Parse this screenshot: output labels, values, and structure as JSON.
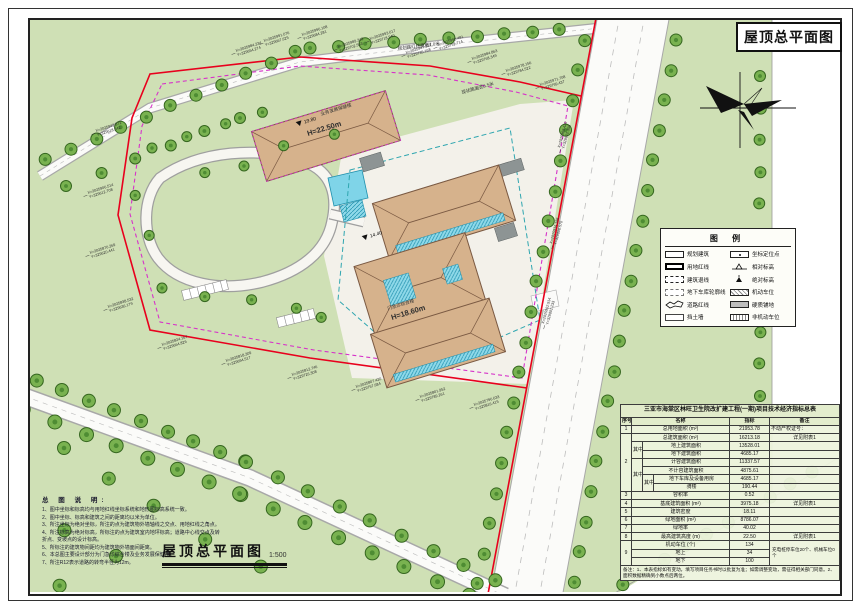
{
  "sheet": {
    "corner_title": "屋顶总平面图",
    "bottom_title": "屋顶总平面图",
    "bottom_scale": "1:500"
  },
  "legend": {
    "title": "图  例",
    "left": [
      {
        "label": "规划建筑"
      },
      {
        "label": "用地红线"
      },
      {
        "label": "建筑退线"
      },
      {
        "label": "地下车库轮廓线"
      },
      {
        "label": "道路红线"
      },
      {
        "label": "挡土墙"
      }
    ],
    "right": [
      {
        "label": "坐标定位点"
      },
      {
        "label": "相对标高"
      },
      {
        "label": "绝对标高"
      },
      {
        "label": "机动车位"
      },
      {
        "label": "硬质铺地"
      },
      {
        "label": "非机动车位"
      }
    ]
  },
  "notes": {
    "title": "总 图 说 明:",
    "items": [
      "1、图中坐标和标高均与用地红线坐标系统和地形图标高系统一致。",
      "2、图中坐标、标高和建筑之间的距离均以米为单位。",
      "3、所注坐标为绝对坐标，所注的点为建筑物外墙轴线之交点、用地红线之角点。",
      "4、所注标高为绝对标高，所标注的点为建筑室内地坪标高；道路中心线交点及转折点、变坡点的设计标高。",
      "5、所标注的建筑物间距均为建筑物外墙面间距离。",
      "6、本总图主要设计部分为门急诊综合楼及业务发展保健楼。",
      "7、所注R12表示道路的转弯半径为12m。"
    ]
  },
  "table": {
    "title": "三亚市海棠区林旺卫生院改扩建工程(一期)项目技术经济指标总表",
    "h_no": "序号",
    "h_name": "名称",
    "h_val": "指标",
    "h_note": "备注",
    "rows": [
      {
        "no": "1",
        "name": "总用地面积 (m²)",
        "val": "21953.78",
        "note": "不动产权证号："
      },
      {
        "no": "2",
        "name": "总建筑面积 (m²)",
        "val": "16213.18",
        "note": "详见附表1"
      },
      {
        "g": "其中",
        "name": "地上建筑面积",
        "val": "13528.01"
      },
      {
        "name": "地下建筑面积",
        "val": "4685.17"
      },
      {
        "g": "其中",
        "name": "计容建筑面积",
        "val": "11337.57"
      },
      {
        "name": "不计容建筑面积",
        "val": "4875.61"
      },
      {
        "g": "其中",
        "name": "地下车库及设备用房",
        "val": "4685.17"
      },
      {
        "name": "骑楼",
        "val": "190.44"
      },
      {
        "no": "3",
        "name": "容积率",
        "val": "0.52"
      },
      {
        "no": "4",
        "name": "基底建筑面积 (m²)",
        "val": "3975.18",
        "note": "详见附表1"
      },
      {
        "no": "5",
        "name": "建筑密度",
        "val": "18.11"
      },
      {
        "no": "6",
        "name": "绿地面积 (m²)",
        "val": "8786.07"
      },
      {
        "no": "7",
        "name": "绿地率",
        "val": "40.02"
      },
      {
        "no": "8",
        "name": "最高建筑高度 (m)",
        "val": "22.50",
        "note": "详见附表1"
      },
      {
        "no": "9",
        "name": "机动车位 (个)",
        "val": "134",
        "note": "充电桩停车位20个、机械车位0个"
      },
      {
        "name": "地上",
        "val": "34"
      },
      {
        "name": "地下",
        "val": "100"
      }
    ],
    "footnote": "备注：1、本表指标如有变动，填写项目任务书时以批复为准；如需调整变动，需征得相关部门同意。2、面积数据精确到小数点后两位。"
  },
  "map": {
    "buildings": [
      {
        "name": "业务发展保健楼",
        "height": "H=22.50m",
        "level": "19.80"
      },
      {
        "name": "门急诊综合楼",
        "height": "H=18.60m",
        "level": "14.40"
      }
    ],
    "road_labels": [
      {
        "text": "规划路红线宽度7.0米"
      },
      {
        "text": "现状路面宽6.5米"
      }
    ],
    "coord_labels": [
      {
        "x": 236,
        "y": 52,
        "r": -18,
        "a": "X=2025984.234",
        "b": "Y=329654.274"
      },
      {
        "x": 264,
        "y": 42,
        "r": -18,
        "a": "X=2025991.076",
        "b": "Y=329667.625"
      },
      {
        "x": 302,
        "y": 36,
        "r": -18,
        "a": "X=2025996.108",
        "b": "Y=329684.281"
      },
      {
        "x": 338,
        "y": 48,
        "r": -18,
        "a": "X=2025989.342",
        "b": "Y=329702.563"
      },
      {
        "x": 370,
        "y": 40,
        "r": -18,
        "a": "X=2025993.617",
        "b": "Y=329718.940"
      },
      {
        "x": 406,
        "y": 54,
        "r": -18,
        "a": "X=2025987.224",
        "b": "Y=329735.168"
      },
      {
        "x": 438,
        "y": 46,
        "r": -18,
        "a": "X=2025990.481",
        "b": "Y=329752.714"
      },
      {
        "x": 472,
        "y": 60,
        "r": -18,
        "a": "X=2025984.863",
        "b": "Y=329768.349"
      },
      {
        "x": 506,
        "y": 72,
        "r": -18,
        "a": "X=2025978.156",
        "b": "Y=329784.522"
      },
      {
        "x": 540,
        "y": 86,
        "r": -18,
        "a": "X=2025971.708",
        "b": "Y=329799.437"
      },
      {
        "x": 96,
        "y": 132,
        "r": -18,
        "a": "X=2025942.371",
        "b": "Y=329618.542"
      },
      {
        "x": 88,
        "y": 194,
        "r": -18,
        "a": "X=2025906.514",
        "b": "Y=329612.708"
      },
      {
        "x": 90,
        "y": 254,
        "r": -18,
        "a": "X=2025870.269",
        "b": "Y=329620.441"
      },
      {
        "x": 108,
        "y": 308,
        "r": -18,
        "a": "X=2025838.532",
        "b": "Y=329636.179"
      },
      {
        "x": 162,
        "y": 346,
        "r": -18,
        "a": "X=2025824.167",
        "b": "Y=329664.826"
      },
      {
        "x": 226,
        "y": 362,
        "r": -18,
        "a": "X=2025818.309",
        "b": "Y=329694.517"
      },
      {
        "x": 292,
        "y": 376,
        "r": -18,
        "a": "X=2025812.746",
        "b": "Y=329726.308"
      },
      {
        "x": 356,
        "y": 388,
        "r": -18,
        "a": "X=2025807.420",
        "b": "Y=329757.684"
      },
      {
        "x": 420,
        "y": 398,
        "r": -18,
        "a": "X=2025801.952",
        "b": "Y=329789.261"
      },
      {
        "x": 474,
        "y": 406,
        "r": -18,
        "a": "X=2025796.633",
        "b": "Y=329816.415"
      },
      {
        "x": 560,
        "y": 148,
        "r": -75,
        "a": "X=2025968.420",
        "b": "Y=329812.358"
      },
      {
        "x": 552,
        "y": 244,
        "r": -75,
        "a": "X=2025934.186",
        "b": "Y=329806.570"
      },
      {
        "x": 544,
        "y": 324,
        "r": -75,
        "a": "X=2025902.914",
        "b": "Y=329801.233"
      }
    ]
  },
  "colors": {
    "map_green": "#cfe0b5",
    "roof_tan": "#d6b28c",
    "red_line": "#e8001d",
    "retreat_magenta": "#d633c9",
    "garage_teal": "#2fa6b0",
    "solar_cyan": "#8fd9e9"
  }
}
